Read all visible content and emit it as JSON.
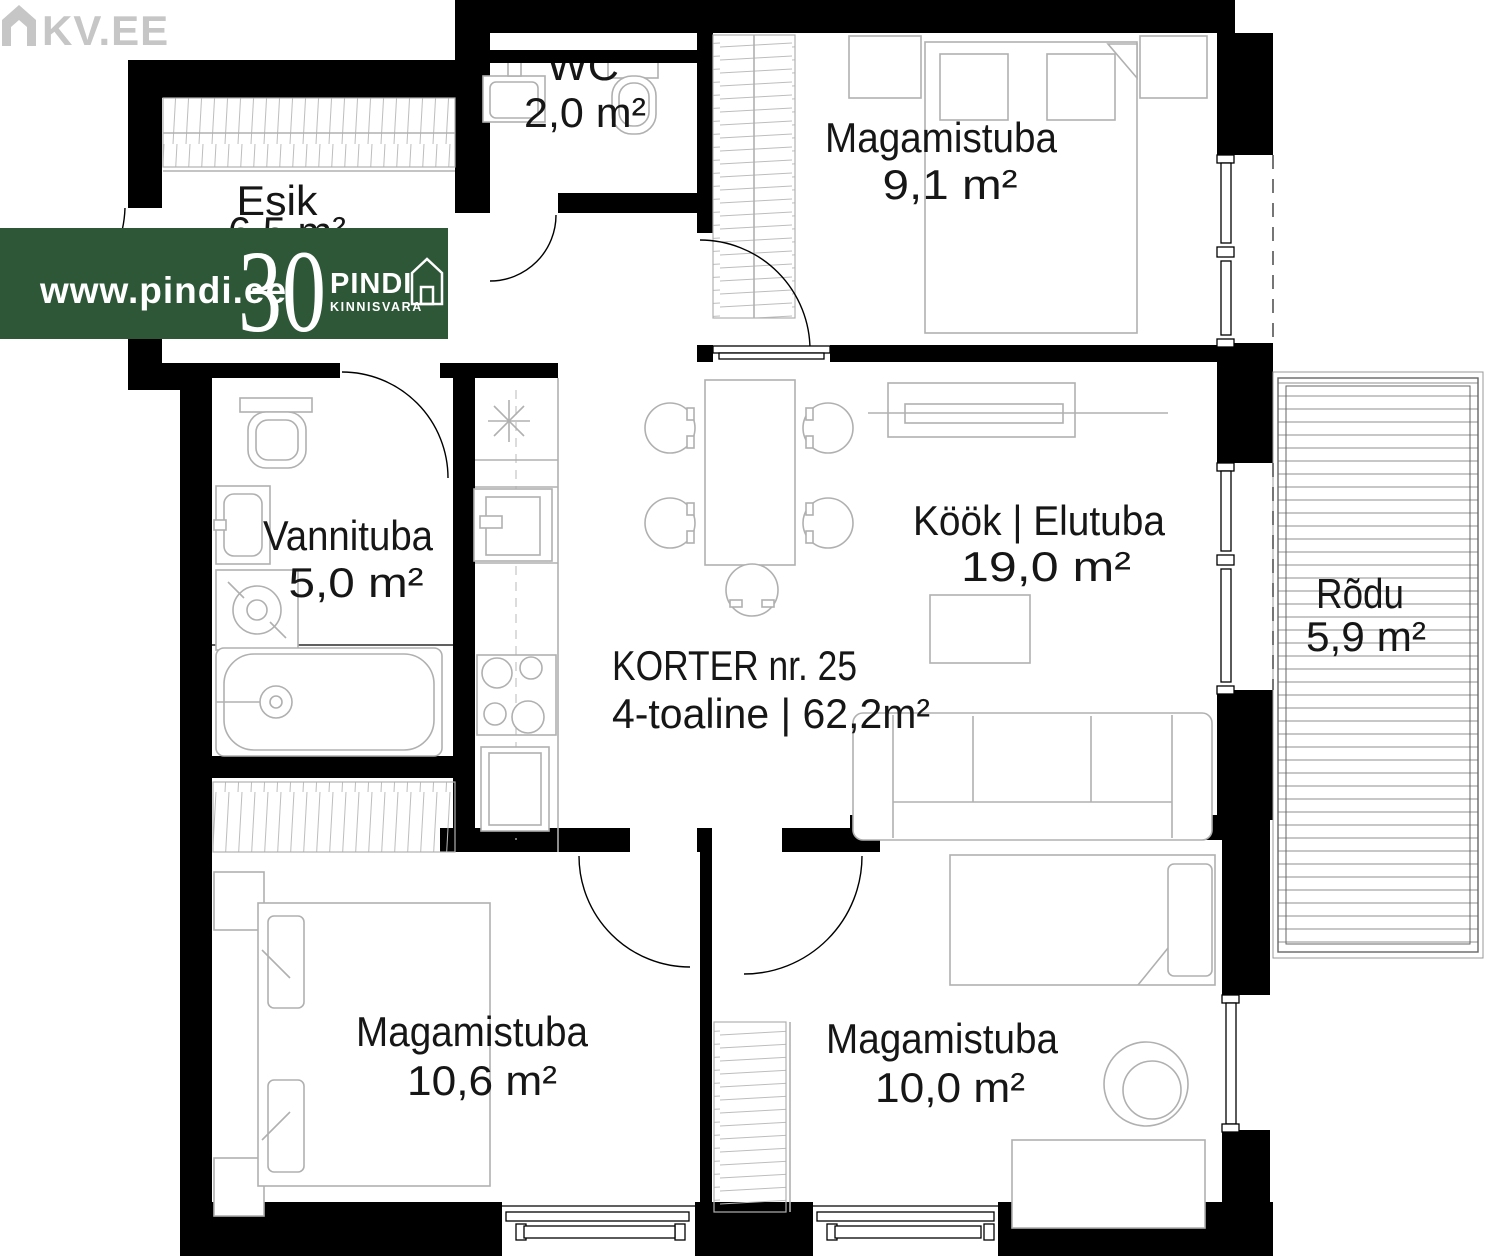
{
  "page": {
    "type": "apartment-floor-plan",
    "background": "#ffffff"
  },
  "branding": {
    "kv_logo_text": "KV.EE",
    "kv_logo_color": "#c6c6c6",
    "banner": {
      "bg": "#2d5737",
      "url": "www.pindi.ee",
      "years": "30",
      "brand": "PINDI",
      "brand_sub": "KINNISVARA"
    }
  },
  "apartment": {
    "title": "KORTER nr.  25",
    "subtitle": "4-toaline | 62,2m²"
  },
  "rooms": [
    {
      "id": "esik",
      "name": "Esik",
      "area": "6,5 m²"
    },
    {
      "id": "wc",
      "name": "WC",
      "area": "2,0 m²"
    },
    {
      "id": "magamistuba-1",
      "name": "Magamistuba",
      "area": "9,1 m²"
    },
    {
      "id": "vannituba",
      "name": "Vannituba",
      "area": "5,0 m²"
    },
    {
      "id": "kook-elutuba",
      "name": "Köök | Elutuba",
      "area": "19,0 m²"
    },
    {
      "id": "rodu",
      "name": "Rõdu",
      "area": "5,9 m²"
    },
    {
      "id": "magamistuba-2",
      "name": "Magamistuba",
      "area": "10,6 m²"
    },
    {
      "id": "magamistuba-3",
      "name": "Magamistuba",
      "area": "10,0 m²"
    }
  ],
  "colors": {
    "wall": "#000000",
    "furniture_line": "#b0b0b0",
    "banner_green": "#2d5737"
  }
}
